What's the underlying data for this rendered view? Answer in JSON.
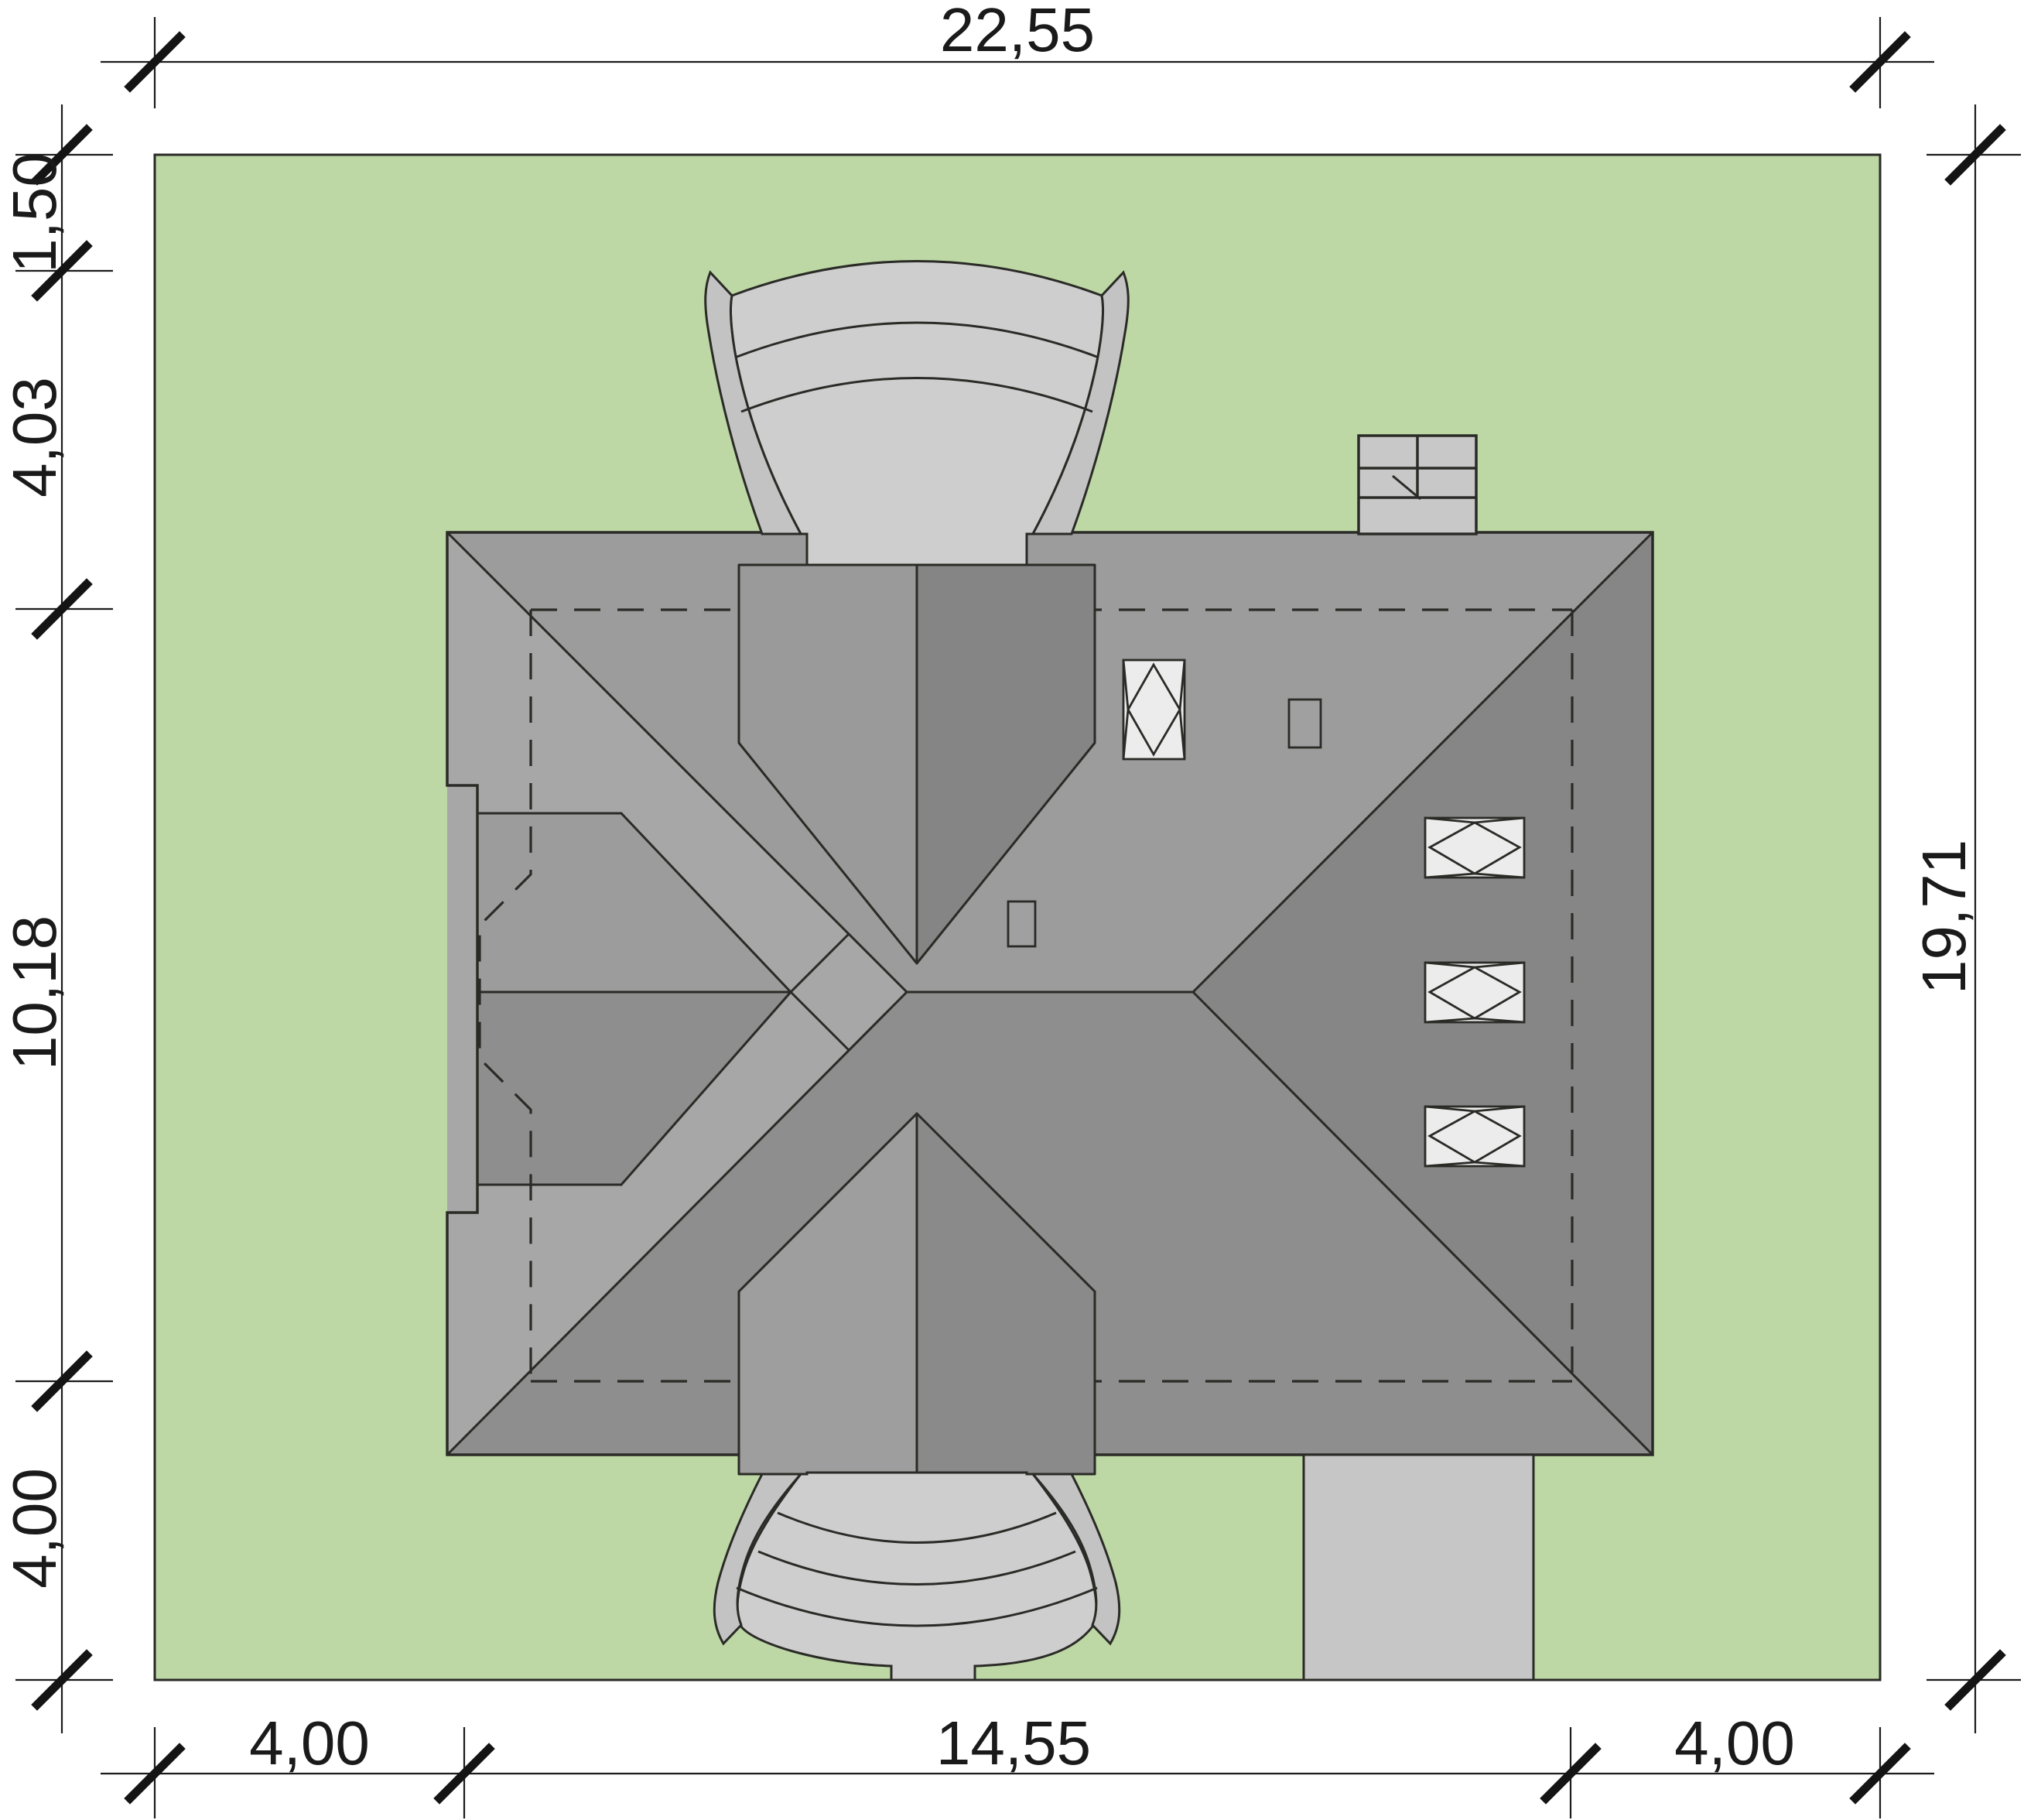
{
  "drawing": {
    "kind": "site-plan-roof-view",
    "plot_fill": "#bdd7a5",
    "roof_north_fill": "#9c9c9c",
    "roof_west_fill": "#a7a7a7",
    "roof_south_fill": "#8e8e8e",
    "roof_east_fill": "#868686",
    "paving_fill": "#cecece",
    "skylight_fill": "#ececec",
    "line_color": "#2a2a26"
  },
  "dimensions": {
    "top": {
      "label": "22,55"
    },
    "left": [
      {
        "label": "1,50"
      },
      {
        "label": "4,03"
      },
      {
        "label": "10,18"
      },
      {
        "label": "4,00"
      }
    ],
    "right": {
      "label": "19,71"
    },
    "bottom": [
      {
        "label": "4,00"
      },
      {
        "label": "14,55"
      },
      {
        "label": "4,00"
      }
    ]
  }
}
